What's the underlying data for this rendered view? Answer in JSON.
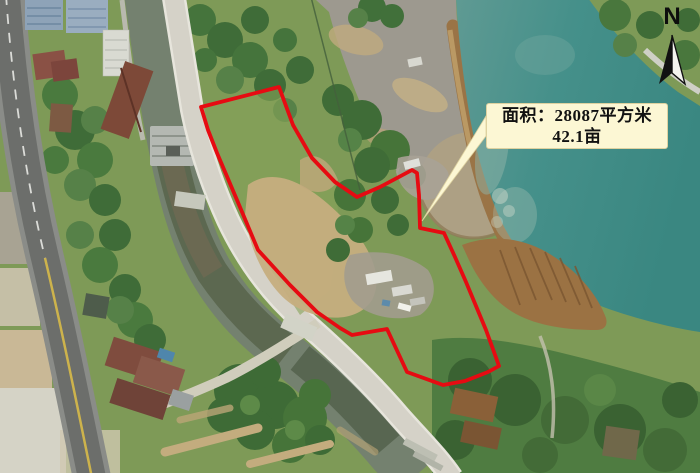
{
  "map": {
    "type": "aerial-photo-land-parcel-annotation",
    "area_label": {
      "line1": "面积：28087平方米",
      "line2": "42.1亩",
      "area_sqm": "28087",
      "area_mu": "42.1"
    },
    "north_indicator": {
      "label": "N"
    },
    "colors": {
      "boundary": "#e60b12",
      "label_background": "#fcf7d4",
      "label_text": "#111111",
      "lake_water": "#48948e",
      "north_arrow": "#111111"
    }
  }
}
